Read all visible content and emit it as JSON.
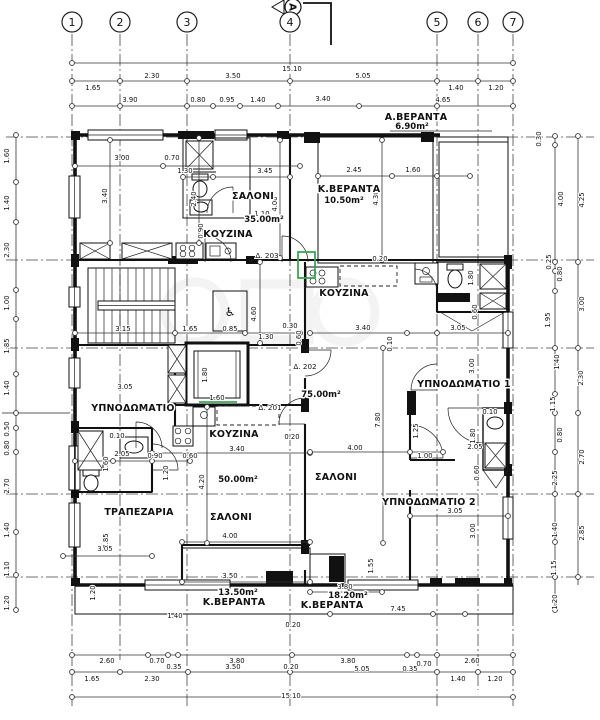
{
  "drawing": {
    "type": "architectural floor plan",
    "overall_width": "15.10",
    "colors": {
      "line": "#111111",
      "door_highlight": "#3aa655",
      "hatch": "#555555",
      "watermark": "#777777"
    }
  },
  "grid": {
    "bubble_y": 22,
    "columns": [
      {
        "n": "1",
        "x": 72
      },
      {
        "n": "2",
        "x": 120
      },
      {
        "n": "3",
        "x": 187
      },
      {
        "n": "4",
        "x": 290
      },
      {
        "n": "5",
        "x": 437
      },
      {
        "n": "6",
        "x": 478
      },
      {
        "n": "7",
        "x": 513
      }
    ],
    "section_marker": {
      "label": "A",
      "x": 293,
      "y": 7
    }
  },
  "rooms": [
    {
      "name": "ΣΑΛΟΝΙ",
      "area": "35.00m²"
    },
    {
      "name": "ΚΟΥΖΙΝΑ",
      "area": ""
    },
    {
      "name": "Κ.ΒΕΡΑΝΤΑ",
      "area": "10.50m²"
    },
    {
      "name": "Α.ΒΕΡΑΝΤΑ",
      "area": "6.90m²"
    },
    {
      "name": "ΚΟΥΖΙΝΑ",
      "area": ""
    },
    {
      "name": "ΥΠΝΟΔΩΜΑΤΙΟ",
      "area": ""
    },
    {
      "name": "ΥΠΝΟΔΩΜΑΤΙΟ 1",
      "area": ""
    },
    {
      "name": "ΥΠΝΟΔΩΜΑΤΙΟ 2",
      "area": ""
    },
    {
      "name": "ΤΡΑΠΕΖΑΡΙΑ",
      "area": ""
    },
    {
      "name": "ΣΑΛΟΝΙ",
      "area": "50.00m²"
    },
    {
      "name": "ΣΑΛΟΝΙ",
      "area": "75.00m²"
    },
    {
      "name": "Κ.ΒΕΡΑΝΤΑ",
      "area": "13.50m²"
    },
    {
      "name": "Κ.ΒΕΡΑΝΤΑ",
      "area": "18.20m²"
    }
  ],
  "annotations": {
    "room_labels": [
      {
        "t": "ΣΑΛΟΝΙ",
        "x": 253,
        "y": 199,
        "s": 10
      },
      {
        "t": "ΚΟΥΖΙΝΑ",
        "x": 228,
        "y": 237,
        "s": 9
      },
      {
        "t": "Κ.ΒΕΡΑΝΤΑ",
        "x": 349,
        "y": 192,
        "s": 9
      },
      {
        "t": "Α.ΒΕΡΑΝΤΑ",
        "x": 416,
        "y": 120,
        "s": 9
      },
      {
        "t": "ΚΟΥΖΙΝΑ",
        "x": 344,
        "y": 296,
        "s": 10
      },
      {
        "t": "ΥΠΝΟΔΩΜΑΤΙΟ",
        "x": 133,
        "y": 411,
        "s": 9
      },
      {
        "t": "ΥΠΝΟΔΩΜΑΤΙΟ 1",
        "x": 464,
        "y": 387,
        "s": 8.5
      },
      {
        "t": "ΥΠΝΟΔΩΜΑΤΙΟ 2",
        "x": 429,
        "y": 505,
        "s": 8.5
      },
      {
        "t": "ΤΡΑΠΕΖΑΡΙΑ",
        "x": 139,
        "y": 515,
        "s": 9
      },
      {
        "t": "ΚΟΥΖΙΝΑ",
        "x": 234,
        "y": 437,
        "s": 9
      },
      {
        "t": "ΣΑΛΟΝΙ",
        "x": 231,
        "y": 520,
        "s": 9
      },
      {
        "t": "ΣΑΛΟΝΙ",
        "x": 336,
        "y": 480,
        "s": 10
      },
      {
        "t": "Κ.ΒΕΡΑΝΤΑ",
        "x": 234,
        "y": 605,
        "s": 8
      },
      {
        "t": "Κ.ΒΕΡΑΝΤΑ",
        "x": 332,
        "y": 608,
        "s": 8
      }
    ],
    "area_labels": [
      {
        "t": "35.00m²",
        "x": 264,
        "y": 222,
        "s": 9
      },
      {
        "t": "10.50m²",
        "x": 344,
        "y": 203,
        "s": 9
      },
      {
        "t": "6.90m²",
        "x": 412,
        "y": 129,
        "s": 8
      },
      {
        "t": "75.00m²",
        "x": 321,
        "y": 397,
        "s": 9
      },
      {
        "t": "50.00m²",
        "x": 238,
        "y": 482,
        "s": 9
      },
      {
        "t": "13.50m²",
        "x": 238,
        "y": 595,
        "s": 8
      },
      {
        "t": "18.20m²",
        "x": 348,
        "y": 598,
        "s": 8
      }
    ],
    "door_labels": [
      {
        "t": "Δ. 203",
        "x": 267,
        "y": 258
      },
      {
        "t": "Δ. 202",
        "x": 305,
        "y": 369
      },
      {
        "t": "Δ. 201",
        "x": 270,
        "y": 410
      }
    ],
    "icons": [
      {
        "t": "♿",
        "x": 230,
        "y": 316,
        "s": 13,
        "n": "wheelchair-icon"
      }
    ],
    "dimensions": [
      {
        "t": "15.10",
        "x": 292,
        "y": 71
      },
      {
        "t": "1.65",
        "x": 93,
        "y": 90
      },
      {
        "t": "2.30",
        "x": 152,
        "y": 78
      },
      {
        "t": "3.50",
        "x": 233,
        "y": 78
      },
      {
        "t": "5.05",
        "x": 363,
        "y": 78
      },
      {
        "t": "1.40",
        "x": 456,
        "y": 90
      },
      {
        "t": "1.20",
        "x": 496,
        "y": 90
      },
      {
        "t": "3.90",
        "x": 130,
        "y": 102
      },
      {
        "t": "0.80",
        "x": 198,
        "y": 102
      },
      {
        "t": "0.95",
        "x": 227,
        "y": 102
      },
      {
        "t": "1.40",
        "x": 258,
        "y": 102
      },
      {
        "t": "3.40",
        "x": 323,
        "y": 101
      },
      {
        "t": "4.65",
        "x": 443,
        "y": 102
      },
      {
        "t": "1.60",
        "x": 9,
        "y": 156,
        "r": 1
      },
      {
        "t": "1.40",
        "x": 9,
        "y": 203,
        "r": 1
      },
      {
        "t": "2.30",
        "x": 9,
        "y": 250,
        "r": 1
      },
      {
        "t": "1.00",
        "x": 9,
        "y": 303,
        "r": 1
      },
      {
        "t": "1.85",
        "x": 9,
        "y": 346,
        "r": 1
      },
      {
        "t": "1.40",
        "x": 9,
        "y": 388,
        "r": 1
      },
      {
        "t": "0.50",
        "x": 9,
        "y": 429,
        "r": 1
      },
      {
        "t": "0.80",
        "x": 9,
        "y": 448,
        "r": 1
      },
      {
        "t": "2.70",
        "x": 9,
        "y": 486,
        "r": 1
      },
      {
        "t": "1.40",
        "x": 9,
        "y": 530,
        "r": 1
      },
      {
        "t": "1.10",
        "x": 9,
        "y": 569,
        "r": 1
      },
      {
        "t": "1.20",
        "x": 9,
        "y": 603,
        "r": 1
      },
      {
        "t": "0.30",
        "x": 541,
        "y": 139,
        "r": 1
      },
      {
        "t": "4.00",
        "x": 563,
        "y": 199,
        "r": 1
      },
      {
        "t": "4.25",
        "x": 584,
        "y": 200,
        "r": 1
      },
      {
        "t": "0.25",
        "x": 551,
        "y": 262,
        "r": 1
      },
      {
        "t": "0.80",
        "x": 562,
        "y": 274,
        "r": 1
      },
      {
        "t": "3.00",
        "x": 584,
        "y": 304,
        "r": 1
      },
      {
        "t": "1.95",
        "x": 550,
        "y": 320,
        "r": 1
      },
      {
        "t": "1.40",
        "x": 559,
        "y": 362,
        "r": 1
      },
      {
        "t": "2.30",
        "x": 583,
        "y": 378,
        "r": 1
      },
      {
        "t": "1.15",
        "x": 555,
        "y": 404,
        "r": 1
      },
      {
        "t": "0.80",
        "x": 562,
        "y": 435,
        "r": 1
      },
      {
        "t": "2.70",
        "x": 584,
        "y": 457,
        "r": 1
      },
      {
        "t": "2.25",
        "x": 557,
        "y": 478,
        "r": 1
      },
      {
        "t": "1.40",
        "x": 557,
        "y": 530,
        "r": 1
      },
      {
        "t": "2.85",
        "x": 584,
        "y": 533,
        "r": 1
      },
      {
        "t": "1.15",
        "x": 556,
        "y": 568,
        "r": 1
      },
      {
        "t": "1.20",
        "x": 557,
        "y": 602,
        "r": 1
      },
      {
        "t": "0.20",
        "x": 293,
        "y": 627
      },
      {
        "t": "2.60",
        "x": 107,
        "y": 663
      },
      {
        "t": "0.70",
        "x": 157,
        "y": 663
      },
      {
        "t": "3.80",
        "x": 237,
        "y": 663
      },
      {
        "t": "3.80",
        "x": 348,
        "y": 663
      },
      {
        "t": "0.70",
        "x": 424,
        "y": 666
      },
      {
        "t": "2.60",
        "x": 472,
        "y": 663
      },
      {
        "t": "0.35",
        "x": 174,
        "y": 669
      },
      {
        "t": "3.50",
        "x": 233,
        "y": 669
      },
      {
        "t": "0.20",
        "x": 291,
        "y": 669
      },
      {
        "t": "5.05",
        "x": 362,
        "y": 671
      },
      {
        "t": "0.35",
        "x": 410,
        "y": 671
      },
      {
        "t": "1.65",
        "x": 92,
        "y": 681
      },
      {
        "t": "2.30",
        "x": 152,
        "y": 681
      },
      {
        "t": "1.40",
        "x": 458,
        "y": 681
      },
      {
        "t": "1.20",
        "x": 495,
        "y": 681
      },
      {
        "t": "15.10",
        "x": 291,
        "y": 698
      },
      {
        "t": "3.00",
        "x": 122,
        "y": 160
      },
      {
        "t": "0.70",
        "x": 172,
        "y": 160
      },
      {
        "t": "3.40",
        "x": 107,
        "y": 196,
        "r": 1
      },
      {
        "t": "1.30",
        "x": 185,
        "y": 173
      },
      {
        "t": "2.40",
        "x": 196,
        "y": 199,
        "r": 1
      },
      {
        "t": "3.45",
        "x": 265,
        "y": 173
      },
      {
        "t": "4.00",
        "x": 277,
        "y": 204,
        "r": 1
      },
      {
        "t": "0.90",
        "x": 203,
        "y": 231,
        "r": 1
      },
      {
        "t": "1.10",
        "x": 262,
        "y": 216
      },
      {
        "t": "2.45",
        "x": 354,
        "y": 172
      },
      {
        "t": "1.60",
        "x": 413,
        "y": 172
      },
      {
        "t": "4.30",
        "x": 378,
        "y": 198,
        "r": 1
      },
      {
        "t": "0.20",
        "x": 380,
        "y": 261
      },
      {
        "t": "3.15",
        "x": 123,
        "y": 331
      },
      {
        "t": "1.65",
        "x": 190,
        "y": 331
      },
      {
        "t": "0.85",
        "x": 230,
        "y": 331
      },
      {
        "t": "4.60",
        "x": 256,
        "y": 314,
        "r": 1
      },
      {
        "t": "1.30",
        "x": 266,
        "y": 339
      },
      {
        "t": "0.30",
        "x": 290,
        "y": 328
      },
      {
        "t": "0.60",
        "x": 301,
        "y": 338,
        "r": 1
      },
      {
        "t": "1.80",
        "x": 207,
        "y": 375,
        "r": 1
      },
      {
        "t": "1.60",
        "x": 217,
        "y": 400
      },
      {
        "t": "3.05",
        "x": 125,
        "y": 389
      },
      {
        "t": "3.40",
        "x": 363,
        "y": 330
      },
      {
        "t": "3.05",
        "x": 458,
        "y": 330
      },
      {
        "t": "1.80",
        "x": 473,
        "y": 278,
        "r": 1
      },
      {
        "t": "0.60",
        "x": 477,
        "y": 312,
        "r": 1
      },
      {
        "t": "0.10",
        "x": 392,
        "y": 344,
        "r": 1
      },
      {
        "t": "7.80",
        "x": 380,
        "y": 420,
        "r": 1
      },
      {
        "t": "3.00",
        "x": 474,
        "y": 366,
        "r": 1
      },
      {
        "t": "0.10",
        "x": 117,
        "y": 438
      },
      {
        "t": "2.05",
        "x": 122,
        "y": 456
      },
      {
        "t": "0.90",
        "x": 155,
        "y": 458
      },
      {
        "t": "0.60",
        "x": 190,
        "y": 458
      },
      {
        "t": "1.60",
        "x": 108,
        "y": 464,
        "r": 1
      },
      {
        "t": "1.20",
        "x": 168,
        "y": 473,
        "r": 1
      },
      {
        "t": "4.20",
        "x": 204,
        "y": 482,
        "r": 1
      },
      {
        "t": "3.40",
        "x": 237,
        "y": 451
      },
      {
        "t": "4.00",
        "x": 230,
        "y": 538
      },
      {
        "t": "2.85",
        "x": 108,
        "y": 541,
        "r": 1
      },
      {
        "t": "3.05",
        "x": 105,
        "y": 551
      },
      {
        "t": "4.00",
        "x": 355,
        "y": 450
      },
      {
        "t": "1.00",
        "x": 425,
        "y": 458
      },
      {
        "t": "1.25",
        "x": 418,
        "y": 431,
        "r": 1
      },
      {
        "t": "0.20",
        "x": 292,
        "y": 439
      },
      {
        "t": "1.80",
        "x": 475,
        "y": 436,
        "r": 1
      },
      {
        "t": "2.05",
        "x": 475,
        "y": 449
      },
      {
        "t": "0.10",
        "x": 490,
        "y": 414
      },
      {
        "t": "0.60",
        "x": 479,
        "y": 473,
        "r": 1
      },
      {
        "t": "3.05",
        "x": 455,
        "y": 513
      },
      {
        "t": "3.00",
        "x": 475,
        "y": 531,
        "r": 1
      },
      {
        "t": "1.20",
        "x": 95,
        "y": 593,
        "r": 1
      },
      {
        "t": "3.50",
        "x": 230,
        "y": 578
      },
      {
        "t": "3.80",
        "x": 345,
        "y": 589
      },
      {
        "t": "7.45",
        "x": 398,
        "y": 611
      },
      {
        "t": "1.55",
        "x": 373,
        "y": 566,
        "r": 1
      },
      {
        "t": "1.40",
        "x": 175,
        "y": 618
      }
    ]
  }
}
